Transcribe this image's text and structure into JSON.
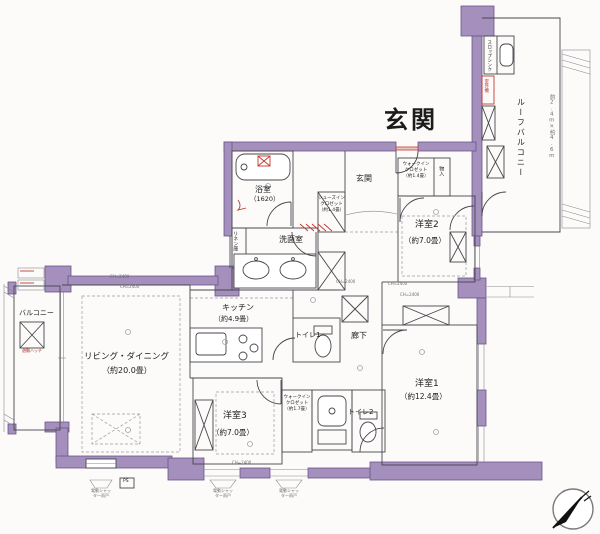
{
  "plan": {
    "labels": {
      "title": "玄関",
      "genkan": "玄関",
      "bathroom": "浴室",
      "bathroom_size": "（1620）",
      "washroom": "洗面室",
      "linen": "リネン庫",
      "sic": [
        "シューズイン",
        "クロゼット",
        "（約1.4畳）"
      ],
      "wic_entrance": [
        "ウォークイン",
        "クロゼット",
        "（約1.4畳）"
      ],
      "storage": "物入",
      "bedroom2": "洋室2",
      "bedroom2_size": "（約7.0畳）",
      "roof_balcony": "ルーフバルコニー",
      "roof_balcony_dim": "約2.4m×約4.6m",
      "slop_sink": "スロップシンク",
      "outdoor_unit": "室外機",
      "kitchen": "キッチン",
      "kitchen_size": "（約4.9畳）",
      "toilet1": "トイレ1",
      "toilet2": "トイレ2",
      "hallway": "廊下",
      "living": "リビング・ダイニング",
      "living_size": "（約20.0畳）",
      "balcony": "バルコニー",
      "bedroom3": "洋室3",
      "bedroom3_size": "（約7.0畳）",
      "bedroom1": "洋室1",
      "bedroom1_size": "（約12.4畳）",
      "wic_inner": [
        "ウォークイン",
        "クロゼット",
        "（約1.7畳）"
      ],
      "ch": "CH=2400",
      "shutter": [
        "電動シャッ",
        "ター雨戸"
      ],
      "ps": "PS",
      "escape_hatch": "避難ハッチ"
    },
    "colors": {
      "wall": "#a48fbd",
      "wall_edge": "#6a5689",
      "line": "#47474d",
      "accent_red": "#c2392f"
    }
  }
}
